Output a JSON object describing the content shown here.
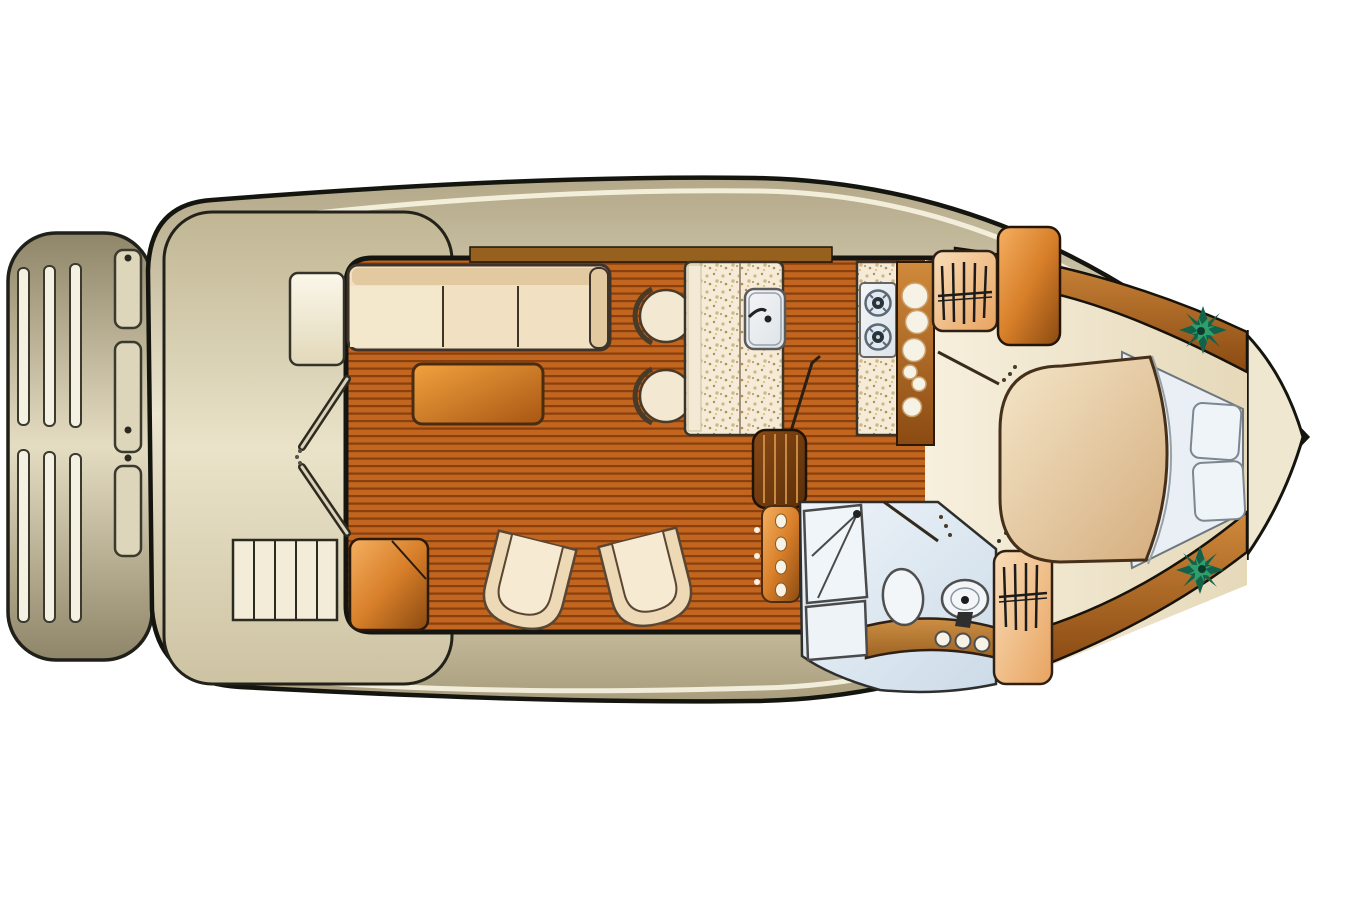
{
  "palette": {
    "outline": "#15150f",
    "hull_edge": "#b3a888",
    "hull_mid": "#ece5cf",
    "hull_low": "#a89d7c",
    "deck_top": "#c0b694",
    "deck_mid": "#eae3c9",
    "deck_low": "#cdc3a3",
    "platform_edge": "#8f8569",
    "platform_mid": "#e5ddc2",
    "accent_stripe": "#f6f1de",
    "plank_base": "#c2661f",
    "plank_line": "#8a3f0e",
    "counter_base": "#f4ecd9",
    "counter_speck1": "#d9b47e",
    "counter_speck2": "#b98c4e",
    "wood_wall_hi": "#d08a3c",
    "wood_wall_lo": "#8a4a12",
    "orange_hi": "#f5b060",
    "orange_mid": "#d87f2a",
    "orange_lo": "#8a4a10",
    "peach_hi": "#f9ddb8",
    "peach_lo": "#e8a360",
    "duvet_hi": "#f4e6c8",
    "duvet_lo": "#d5ad7e",
    "bench_hi": "#fbf7ea",
    "bench_lo": "#e2d8ba",
    "fixture_hi": "#f4f6f8",
    "fixture_lo": "#dde3e8",
    "tile_hi": "#eef4f9",
    "tile_lo": "#ccdbe8",
    "cream_hi": "#f7f0dd",
    "cream_lo": "#e6d9ba",
    "darkwood_hi": "#8a4a16",
    "darkwood_lo": "#5a2e08",
    "table_hi": "#f2a23e",
    "table_lo": "#a85613",
    "vanity_hi": "#cd8f45",
    "vanity_lo": "#9c6322",
    "trim_wood": "#96601f",
    "sofa_fill": "#f1e1c2",
    "sofa_back": "#e2c9a0",
    "sofa_stroke": "#40342a",
    "chair_fill": "#eed9b6",
    "chair_inner": "#f6ebd2",
    "chair_stroke": "#5a4632",
    "stool_fill": "#f3e8d2",
    "white_fixture": "#f3f6f9",
    "fixture_stroke": "#4f4f4f",
    "pillow_fill": "#eff4f9",
    "pillow_stroke": "#7d8790",
    "sheet_fill": "#e9eff5",
    "plant_dark": "#14614a",
    "plant_light": "#2e9e6b",
    "steel": "#3a3a2e",
    "tread_fill": "#f2ecd8",
    "circle_fill": "#f6f2e6"
  },
  "floorplan": {
    "type": "yacht-interior-deck-plan",
    "orientation": "bow-right-stern-left",
    "areas": {
      "swim_platform": {
        "slats": 6
      },
      "aft_deck": {
        "bench": 1,
        "entry_door_leaves": 2,
        "steps_treads": 5,
        "boarding_ladder_segments": 3
      },
      "salon": {
        "sofa_cushions": 3,
        "coffee_table": 1,
        "armchairs": 2,
        "corner_cabinet": 1
      },
      "dinette": {
        "stools": 2
      },
      "galley": {
        "sink": 1,
        "stove_burners": 2,
        "storage_circles": 6,
        "companionway_steps": 1,
        "companionway_ladder_rungs": 4
      },
      "head": {
        "shower": 1,
        "toilet": 1,
        "washbasin": 1,
        "vanity_knobs": 3,
        "hanging_locker_hangers": 4
      },
      "bow_cabin": {
        "island_berth": 1,
        "pillows": 2,
        "plants": 2,
        "hanging_locker_hangers": 5,
        "wardrobe": 1
      }
    }
  }
}
